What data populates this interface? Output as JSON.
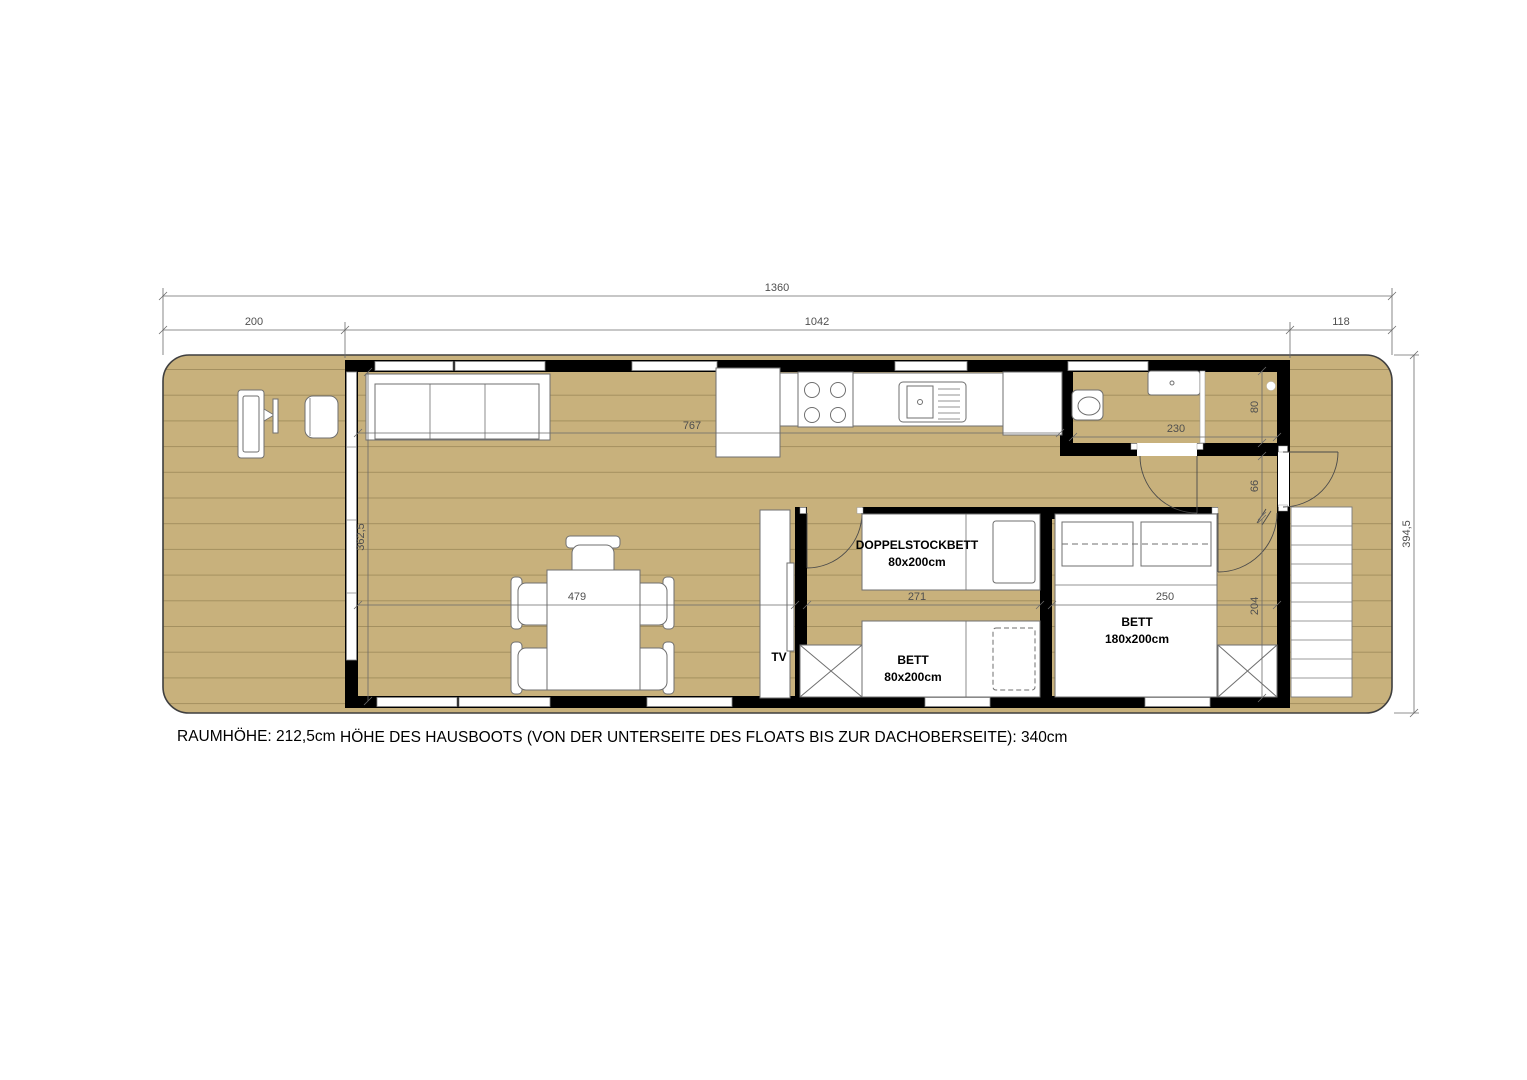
{
  "plan": {
    "notes": {
      "room_height": "RAUMHÖHE: 212,5cm",
      "boat_height": "HÖHE DES HAUSBOOTS (VON DER UNTERSEITE DES FLOATS BIS ZUR DACHOBERSEITE): 340cm"
    },
    "dims": {
      "total_length": "1360",
      "front_deck": "200",
      "cabin_length": "1042",
      "rear_deck": "118",
      "beam": "394,5",
      "interior_width": "362,5",
      "living_length": "767",
      "bath_width": "230",
      "bath_depth": "80",
      "hall_width": "66",
      "living_width": "479",
      "bunkroom_width": "271",
      "bedroom_width": "250",
      "bedroom_depth": "204"
    },
    "labels": {
      "bunk_bed_name": "DOPPELSTOCKBETT",
      "bunk_bed_size": "80x200cm",
      "single_bed_name": "BETT",
      "single_bed_size": "80x200cm",
      "double_bed_name": "BETT",
      "double_bed_size": "180x200cm",
      "tv": "TV"
    },
    "colors": {
      "floor": "#c8b17c",
      "plank_line": "#a4905f",
      "wall": "#000000",
      "furniture_outline": "#6f6f6f",
      "dim_gray": "#4f4f4f"
    }
  }
}
